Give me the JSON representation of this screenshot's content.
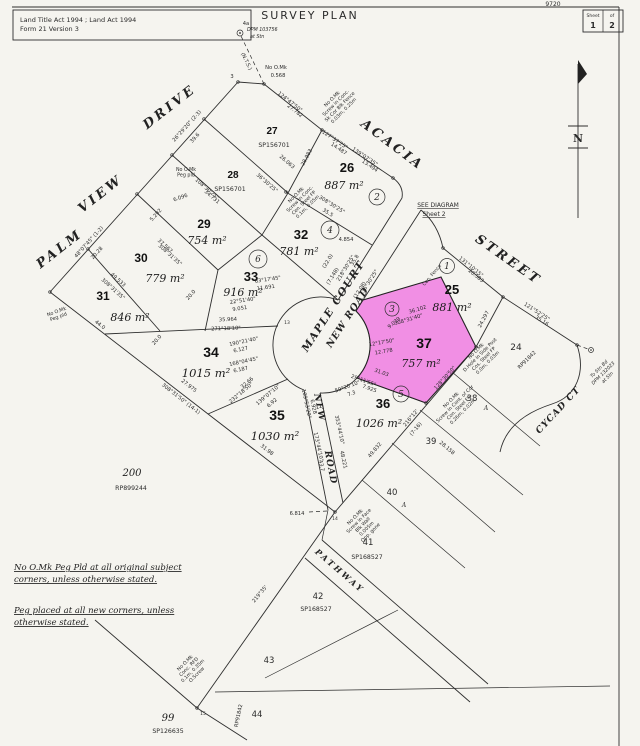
{
  "header": {
    "act_line": "Land Title Act 1994 ;  Land Act 1994",
    "form_line": "Form 21 Version 3",
    "title": "SURVEY PLAN",
    "plan_number": "9720",
    "sheet": {
      "label": "Sheet",
      "number": "1",
      "of": "of",
      "total": "2"
    }
  },
  "north_label": "N",
  "highlight_color": "#F07CE2",
  "see_diagram": {
    "l1": "SEE DIAGRAM",
    "l2": "Sheet 2"
  },
  "notes": {
    "n1l1": "No O.Mk Peg Pld at all original subject",
    "n1l2": "corners, unless otherwise stated.",
    "n2l1": "Peg placed at all new corners, unless",
    "n2l2": "otherwise stated."
  },
  "streets": {
    "palm": "PALM",
    "view": "VIEW",
    "drive": "DRIVE",
    "acacia": "ACACIA",
    "street": "STREET",
    "maple_court": "MAPLE  COURT",
    "new_road": "NEW  ROAD",
    "road_width": "(12.08)",
    "new_lower": "NEW",
    "road_lower": "ROAD",
    "cycad": "CYCAD CT",
    "pathway": "PATHWAY"
  },
  "lots": {
    "l24": {
      "num": "24",
      "ref": "RP91842"
    },
    "l25": {
      "num": "25",
      "area": "881 m²"
    },
    "l26": {
      "num": "26",
      "area": "887 m²"
    },
    "l27": {
      "num": "27",
      "ref": "SP156701"
    },
    "l28": {
      "num": "28",
      "ref": "SP156701"
    },
    "l29": {
      "num": "29",
      "area": "754 m²"
    },
    "l30": {
      "num": "30",
      "area": "779 m²"
    },
    "l31": {
      "num": "31",
      "area": "846 m²"
    },
    "l32": {
      "num": "32",
      "area": "781 m²"
    },
    "l33": {
      "num": "33",
      "area": "916 m²"
    },
    "l34": {
      "num": "34",
      "area": "1015 m²"
    },
    "l35": {
      "num": "35",
      "area": "1030 m²"
    },
    "l36": {
      "num": "36",
      "area": "1026 m²"
    },
    "l37": {
      "num": "37",
      "area": "757 m²"
    },
    "l38": {
      "num": "38"
    },
    "l39": {
      "num": "39"
    },
    "l40": {
      "num": "40"
    },
    "l41": {
      "num": "41",
      "ref": "SP168527"
    },
    "l42": {
      "num": "42",
      "ref": "SP168527"
    },
    "l43": {
      "num": "43"
    },
    "l44": {
      "num": "44",
      "ref": "RP91842"
    },
    "l99": {
      "num": "99",
      "ref": "SP126635"
    },
    "l200": {
      "num": "200",
      "ref": "RP899244"
    }
  },
  "circles": {
    "c1": "1",
    "c2": "2",
    "c3": "3",
    "c4": "4",
    "c5": "5",
    "c6": "6"
  },
  "points": {
    "p3": "3",
    "p13": "13",
    "p14": "14",
    "p15": "15"
  },
  "symbols": {
    "a1": "A",
    "a2": "A"
  },
  "marks": {
    "m4a": {
      "pt": "4a",
      "l1": "DPM 103756",
      "l2": "at Stn"
    },
    "nts": "(N.T.S.)",
    "right": {
      "l1": "To Stn Bd",
      "l2": "DPM 132023",
      "l3": "at Stn"
    },
    "mk1": {
      "l1": "No O.Mk",
      "l2": "Screw in Conc.",
      "l3": "Sk Cor Blk Fence",
      "l4": "0.03m, 0.25m"
    },
    "mk2": {
      "l1": "No O.Mk",
      "l2": "Screw in Conc.",
      "l3": "Cen. Steel FP",
      "l4": "0.1m, 0.05m"
    },
    "mk3": {
      "l1": "No O.Mk",
      "l2": "D.Hole in Side Post",
      "l3": "Cos. Steel FP",
      "l4": "0.0m, 0.03m"
    },
    "mk4": {
      "l1": "No O.Mk",
      "l2": "Screw in Cont. of Cor",
      "l3": "Con. Steel FP",
      "l4": "0.26m, 0.02m"
    },
    "mk5": {
      "l1": "No O.Mk",
      "l2": "Screw in Face",
      "l3": "Blk Wall",
      "l4": "0.005m",
      "l5": "Opp. gone"
    },
    "mk6": {
      "l1": "No O.Mk",
      "l2": "Conc. RFD",
      "l3": "0.1m, 0.35m",
      "l4": "O.Screw"
    },
    "mk7": {
      "l1": "No O.Mk",
      "l2": "Peg pld"
    },
    "mk8": {
      "l1": "No O.Mk",
      "l2": "Peg pld"
    }
  },
  "bearings": {
    "b1": "26°29'20\" (2-3)",
    "b2": "39.6",
    "b3": "48°07'45\" (1-2)",
    "b4": "20.28",
    "b5": "108°30'25\"",
    "b6": "34.731",
    "b7": "49.533",
    "b8": "308°31'35\"",
    "b9": "37.567",
    "b10": "308°31'35\"",
    "b11": "44.0",
    "b12": "20.0",
    "b13": "20.0",
    "b14": "5.292",
    "b15": "6.096",
    "b16": "36°30'25\"",
    "b17": "26.063",
    "b18": "124°47'50\"",
    "b19": "27.782",
    "b20": "No O.Mk",
    "b21": "0.568",
    "b22": "28.983",
    "b23": "127°37'25\"",
    "b24": "14.487",
    "b25": "139°07'35\"",
    "b26": "13.494",
    "b27": "308°30'25\"",
    "b28": "35.5",
    "b29": "4.854",
    "b30": "(22.0)",
    "b31": "(7.148)",
    "b32": "218°30'25\"",
    "b33": "36°30'25\"",
    "b34": "35.8",
    "b35": "63°17'45\"",
    "b36": "11.691",
    "b37": "22°51'40\"",
    "b38": "9.051",
    "b39": "35.964",
    "b40": "271°18'10\"",
    "b41": "190°21'40\"",
    "b42": "6.127",
    "b43": "168°04'45\"",
    "b44": "6.187",
    "b45": "32.66",
    "b46": "232°18'50\"",
    "b47": "139°07'10\"",
    "b48": "6.92",
    "b49": "27.975",
    "b50": "308°31'50\" (14-1)",
    "b51": "31.98",
    "b52": "109°53'20\"",
    "b53": "6.928",
    "b54": "59°20'10\"",
    "b55": "7.3",
    "b56": "173°44'10\"",
    "b57": "43.7",
    "b58": "353°44'10\"",
    "b59": "48.221",
    "b60": "6.814",
    "b61": "49.832",
    "b62": "216°12'",
    "b63": "(7-16)",
    "b64": "28.158",
    "b65": "9.039",
    "b66": "12°17'50\"",
    "b67": "12.778",
    "b68": "36.102",
    "b69": "308°31'40\"",
    "b70": "128°30'50\"",
    "b71": "29°11'55\"",
    "b72": "7.925",
    "b73": "31.03",
    "b74": "131°10'15\"",
    "b75": "20.583",
    "b76": "121°52'25\"",
    "b77": "35.16",
    "b78": "24.297",
    "b79": "Cen. Fence",
    "b80": "219°35'"
  }
}
